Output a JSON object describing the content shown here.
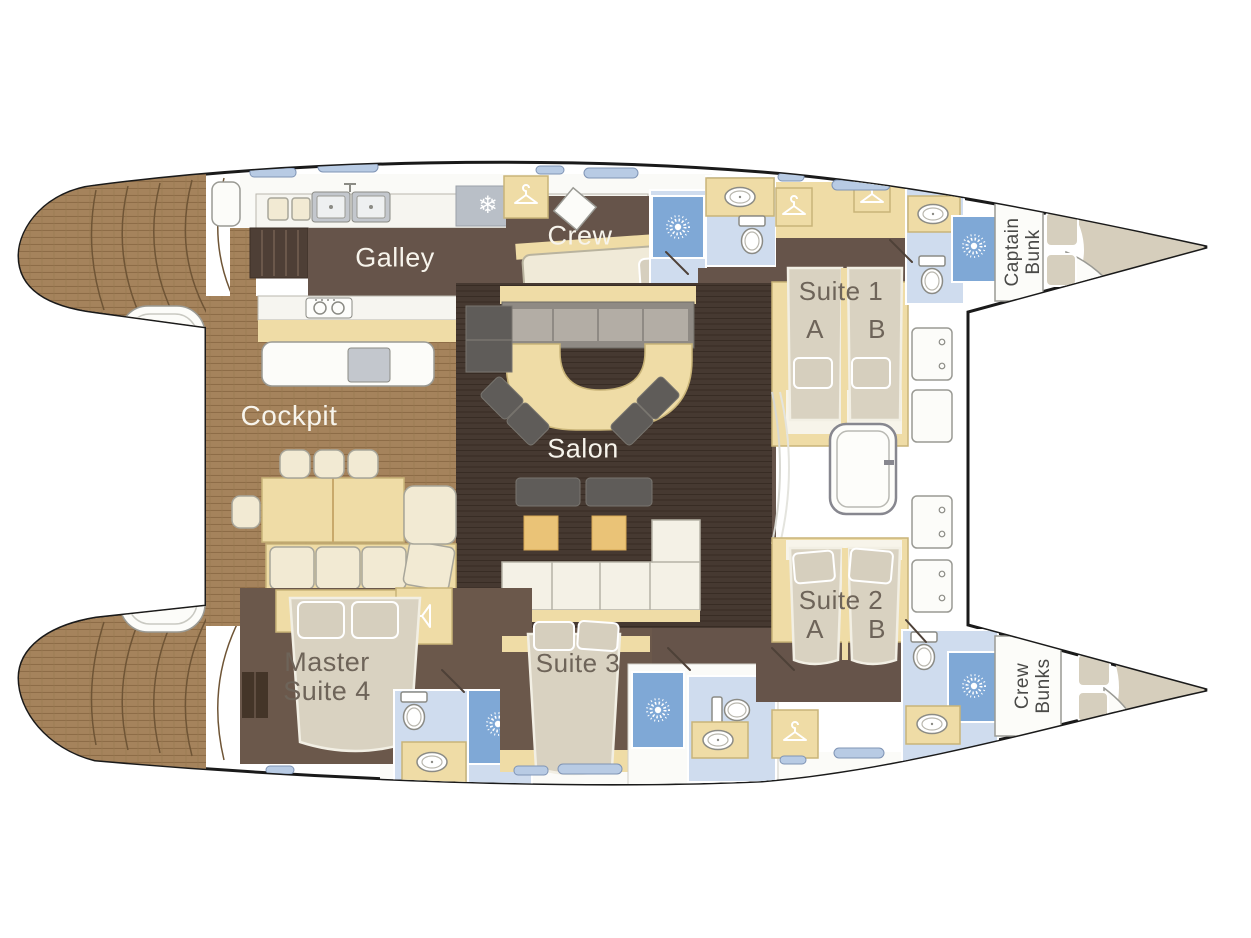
{
  "title": "Catamaran yacht deck / accommodation plan",
  "rooms": {
    "galley": "Galley",
    "crew": "Crew",
    "cockpit": "Cockpit",
    "salon": "Salon",
    "suite1": {
      "name": "Suite 1",
      "a": "A",
      "b": "B"
    },
    "suite2": {
      "name": "Suite 2",
      "a": "A",
      "b": "B"
    },
    "suite3": "Suite 3",
    "master": {
      "line1": "Master",
      "line2": "Suite 4"
    },
    "captain_bunk": {
      "line1": "Captain",
      "line2": "Bunk"
    },
    "crew_bunks": {
      "line1": "Crew",
      "line2": "Bunks"
    }
  },
  "icons": {
    "fridge_glyph": "❄",
    "fridge": "snowflake-icon",
    "shower": "shower-sunburst-icon",
    "closet": "clothes-hanger-icon",
    "toilet": "toilet-icon",
    "sink": "sink-icon",
    "stove": "stove-burners-icon",
    "deck_hatch": "deck-hatch-icon"
  },
  "colors": {
    "hull_outline": "#1a1a1a",
    "deck_wood": "#a5835c",
    "floor_dark": "#66544a",
    "salon_floor": "#463931",
    "furniture_tan": "#efdca6",
    "bathroom_blue": "#cfdcee",
    "shower_blue": "#7fa8d6",
    "bed": "#d9d2c1",
    "window_blue": "#b8cbe4",
    "accent_amber": "#eac377"
  }
}
